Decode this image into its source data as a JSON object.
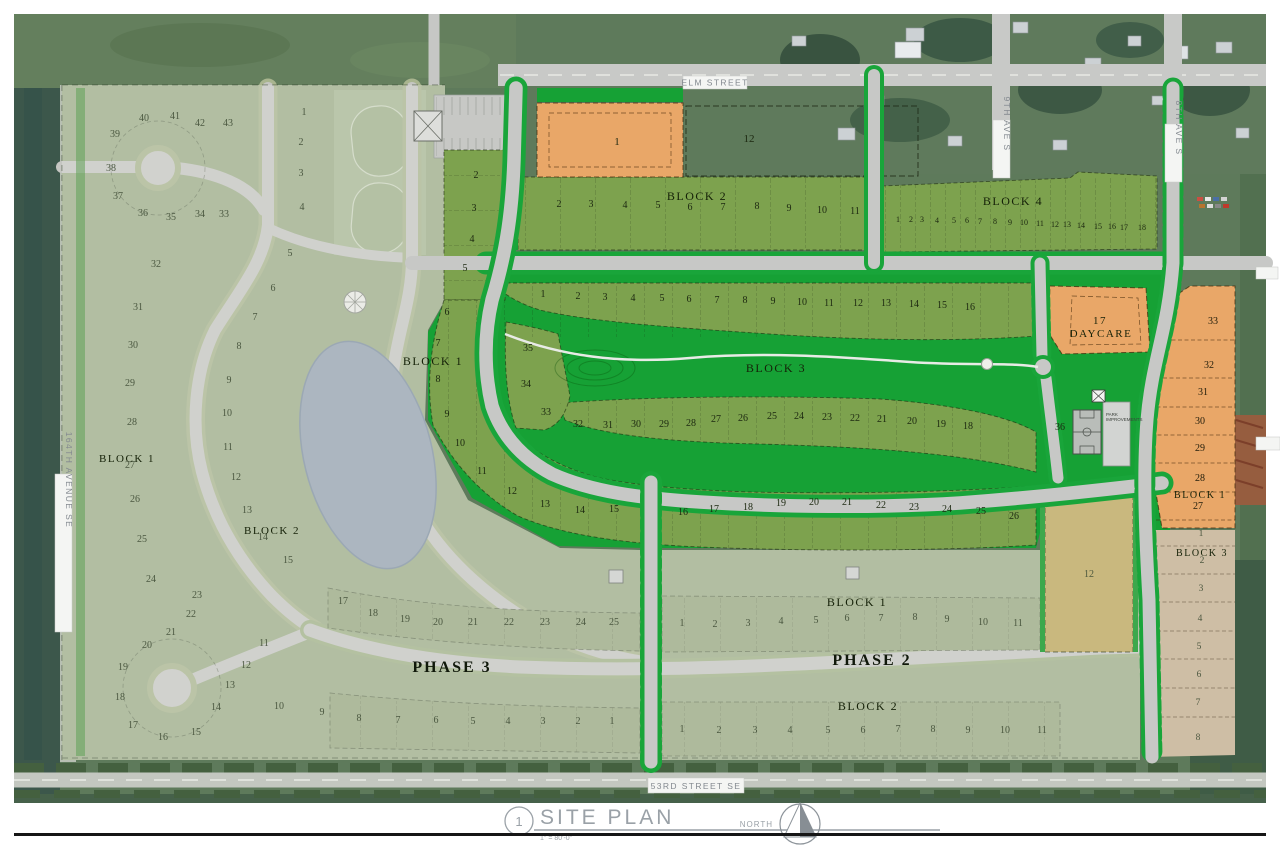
{
  "drawing": {
    "title_block": {
      "detail_number": "1",
      "title": "SITE PLAN",
      "scale": "1\" = 80'-0\"",
      "north_label": "NORTH"
    },
    "streets": {
      "elm": "ELM STREET",
      "ninth_ave": "9TH AVE S",
      "eighth_ave": "8TH AVE S",
      "avenue_164": "164TH AVENUE SE",
      "street_53": "53RD STREET SE"
    },
    "phases": {
      "phase2": "PHASE 2",
      "phase3": "PHASE 3"
    },
    "special_lots": {
      "daycare_number": "17",
      "daycare_label": "DAYCARE",
      "park_improvements_line1": "PARK",
      "park_improvements_line2": "IMPROVEMENTS"
    },
    "block_labels": [
      [
        "BLOCK 2",
        697,
        200,
        12
      ],
      [
        "BLOCK 4",
        1013,
        205,
        12
      ],
      [
        "BLOCK 3",
        776,
        372,
        12
      ],
      [
        "BLOCK 1",
        433,
        365,
        12
      ],
      [
        "BLOCK 1",
        1200,
        498,
        10
      ],
      [
        "BLOCK 3",
        1202,
        556,
        10
      ],
      [
        "BLOCK 1",
        127,
        462,
        11
      ],
      [
        "BLOCK 2",
        272,
        534,
        11
      ],
      [
        "BLOCK 1",
        857,
        606,
        12
      ],
      [
        "BLOCK 2",
        868,
        710,
        12
      ]
    ],
    "lot_groups": [
      {
        "name": "block2-north",
        "cls": "active",
        "fs": 10,
        "lots": [
          [
            "2",
            559,
            207
          ],
          [
            "3",
            591,
            207
          ],
          [
            "4",
            625,
            208
          ],
          [
            "5",
            658,
            208
          ],
          [
            "6",
            690,
            210
          ],
          [
            "7",
            723,
            210
          ],
          [
            "8",
            757,
            209
          ],
          [
            "9",
            789,
            211
          ],
          [
            "10",
            822,
            213
          ],
          [
            "11",
            855,
            214
          ]
        ]
      },
      {
        "name": "block4",
        "cls": "active",
        "fs": 8,
        "lots": [
          [
            "1",
            898,
            222
          ],
          [
            "2",
            911,
            222
          ],
          [
            "3",
            922,
            222
          ],
          [
            "4",
            937,
            223
          ],
          [
            "5",
            954,
            223
          ],
          [
            "6",
            967,
            223
          ],
          [
            "7",
            980,
            224
          ],
          [
            "8",
            995,
            224
          ],
          [
            "9",
            1010,
            225
          ],
          [
            "10",
            1024,
            225
          ],
          [
            "11",
            1040,
            226
          ],
          [
            "12",
            1055,
            227
          ],
          [
            "13",
            1067,
            227
          ],
          [
            "14",
            1081,
            228
          ],
          [
            "15",
            1098,
            229
          ],
          [
            "16",
            1112,
            229
          ],
          [
            "17",
            1124,
            230
          ],
          [
            "18",
            1142,
            230
          ]
        ]
      },
      {
        "name": "block3-top-row",
        "cls": "active",
        "fs": 10,
        "lots": [
          [
            "1",
            543,
            297
          ],
          [
            "2",
            578,
            299
          ],
          [
            "3",
            605,
            300
          ],
          [
            "4",
            633,
            301
          ],
          [
            "5",
            662,
            301
          ],
          [
            "6",
            689,
            302
          ],
          [
            "7",
            717,
            303
          ],
          [
            "8",
            745,
            303
          ],
          [
            "9",
            773,
            304
          ],
          [
            "10",
            802,
            305
          ],
          [
            "11",
            829,
            306
          ],
          [
            "12",
            858,
            306
          ],
          [
            "13",
            886,
            306
          ],
          [
            "14",
            914,
            307
          ],
          [
            "15",
            942,
            308
          ],
          [
            "16",
            970,
            310
          ]
        ]
      },
      {
        "name": "block3-inner-row",
        "cls": "active",
        "fs": 10,
        "lots": [
          [
            "35",
            528,
            351
          ],
          [
            "34",
            526,
            387
          ],
          [
            "33",
            546,
            415
          ],
          [
            "32",
            578,
            427
          ],
          [
            "31",
            608,
            428
          ],
          [
            "30",
            636,
            427
          ],
          [
            "29",
            664,
            427
          ],
          [
            "28",
            691,
            426
          ],
          [
            "27",
            716,
            422
          ],
          [
            "26",
            743,
            421
          ],
          [
            "25",
            772,
            419
          ],
          [
            "24",
            799,
            419
          ],
          [
            "23",
            827,
            420
          ],
          [
            "22",
            855,
            421
          ],
          [
            "21",
            882,
            422
          ],
          [
            "20",
            912,
            424
          ],
          [
            "19",
            941,
            427
          ],
          [
            "18",
            968,
            429
          ]
        ]
      },
      {
        "name": "block1-east-outer",
        "cls": "active",
        "fs": 10,
        "lots": [
          [
            "2",
            476,
            178
          ],
          [
            "3",
            474,
            211
          ],
          [
            "4",
            472,
            242
          ],
          [
            "5",
            465,
            271
          ],
          [
            "6",
            447,
            315
          ],
          [
            "7",
            438,
            346
          ],
          [
            "8",
            438,
            382
          ],
          [
            "9",
            447,
            417
          ],
          [
            "10",
            460,
            446
          ],
          [
            "11",
            482,
            474
          ],
          [
            "12",
            512,
            494
          ],
          [
            "13",
            545,
            507
          ],
          [
            "14",
            580,
            513
          ],
          [
            "15",
            614,
            512
          ],
          [
            "16",
            683,
            515
          ],
          [
            "17",
            714,
            512
          ],
          [
            "18",
            748,
            510
          ],
          [
            "19",
            781,
            506
          ],
          [
            "20",
            814,
            505
          ],
          [
            "21",
            847,
            505
          ],
          [
            "22",
            881,
            508
          ],
          [
            "23",
            914,
            510
          ],
          [
            "24",
            947,
            512
          ],
          [
            "25",
            981,
            514
          ],
          [
            "26",
            1014,
            519
          ]
        ]
      },
      {
        "name": "right-orange-column",
        "cls": "orange-lots",
        "fs": 10,
        "lots": [
          [
            "33",
            1213,
            324
          ],
          [
            "32",
            1209,
            368
          ],
          [
            "31",
            1203,
            395
          ],
          [
            "30",
            1200,
            424
          ],
          [
            "29",
            1200,
            451
          ],
          [
            "28",
            1200,
            481
          ],
          [
            "27",
            1198,
            509
          ]
        ]
      },
      {
        "name": "right-tan-column",
        "cls": "faded",
        "fs": 9.5,
        "lots": [
          [
            "1",
            1201,
            536
          ],
          [
            "2",
            1202,
            563
          ],
          [
            "3",
            1201,
            591
          ],
          [
            "4",
            1200,
            621
          ],
          [
            "5",
            1199,
            649
          ],
          [
            "6",
            1199,
            677
          ],
          [
            "7",
            1198,
            705
          ],
          [
            "8",
            1198,
            740
          ]
        ]
      },
      {
        "name": "phase3-north-row",
        "cls": "faded",
        "fs": 10,
        "lots": [
          [
            "17",
            343,
            604
          ],
          [
            "18",
            373,
            616
          ],
          [
            "19",
            405,
            622
          ],
          [
            "20",
            438,
            625
          ],
          [
            "21",
            473,
            625
          ],
          [
            "22",
            509,
            625
          ],
          [
            "23",
            545,
            625
          ],
          [
            "24",
            581,
            625
          ],
          [
            "25",
            614,
            625
          ]
        ]
      },
      {
        "name": "phase3-south-row",
        "cls": "faded",
        "fs": 10,
        "lots": [
          [
            "10",
            279,
            709
          ],
          [
            "9",
            322,
            715
          ],
          [
            "8",
            359,
            721
          ],
          [
            "7",
            398,
            723
          ],
          [
            "6",
            436,
            723
          ],
          [
            "5",
            473,
            724
          ],
          [
            "4",
            508,
            724
          ],
          [
            "3",
            543,
            724
          ],
          [
            "2",
            578,
            724
          ],
          [
            "1",
            612,
            724
          ]
        ]
      },
      {
        "name": "phase2-north-row",
        "cls": "faded",
        "fs": 10,
        "lots": [
          [
            "1",
            682,
            626
          ],
          [
            "2",
            715,
            627
          ],
          [
            "3",
            748,
            626
          ],
          [
            "4",
            781,
            624
          ],
          [
            "5",
            816,
            623
          ],
          [
            "6",
            847,
            621
          ],
          [
            "7",
            881,
            621
          ],
          [
            "8",
            915,
            620
          ],
          [
            "9",
            947,
            622
          ],
          [
            "10",
            983,
            625
          ],
          [
            "11",
            1018,
            626
          ]
        ]
      },
      {
        "name": "phase2-south-row",
        "cls": "faded",
        "fs": 10,
        "lots": [
          [
            "1",
            682,
            732
          ],
          [
            "2",
            719,
            733
          ],
          [
            "3",
            755,
            733
          ],
          [
            "4",
            790,
            733
          ],
          [
            "5",
            828,
            733
          ],
          [
            "6",
            863,
            733
          ],
          [
            "7",
            898,
            732
          ],
          [
            "8",
            933,
            732
          ],
          [
            "9",
            968,
            733
          ],
          [
            "10",
            1005,
            733
          ],
          [
            "11",
            1042,
            733
          ]
        ]
      },
      {
        "name": "northwest-outer",
        "cls": "faded",
        "fs": 10,
        "lots": [
          [
            "40",
            144,
            121
          ],
          [
            "41",
            175,
            119
          ],
          [
            "42",
            200,
            126
          ],
          [
            "43",
            228,
            126
          ],
          [
            "39",
            115,
            137
          ],
          [
            "38",
            111,
            171
          ],
          [
            "37",
            118,
            199
          ],
          [
            "36",
            143,
            216
          ],
          [
            "35",
            171,
            220
          ],
          [
            "34",
            200,
            217
          ],
          [
            "33",
            224,
            217
          ],
          [
            "32",
            156,
            267
          ],
          [
            "31",
            138,
            310
          ],
          [
            "30",
            133,
            348
          ],
          [
            "29",
            130,
            386
          ],
          [
            "28",
            132,
            425
          ],
          [
            "27",
            130,
            468
          ],
          [
            "26",
            135,
            502
          ],
          [
            "25",
            142,
            542
          ],
          [
            "24",
            151,
            582
          ],
          [
            "23",
            197,
            598
          ]
        ]
      },
      {
        "name": "northwest-column",
        "cls": "faded",
        "fs": 10,
        "lots": [
          [
            "1",
            304,
            115
          ],
          [
            "2",
            301,
            145
          ],
          [
            "3",
            301,
            176
          ],
          [
            "4",
            302,
            210
          ],
          [
            "5",
            290,
            256
          ],
          [
            "6",
            273,
            291
          ],
          [
            "7",
            255,
            320
          ]
        ]
      },
      {
        "name": "west-inner-ring",
        "cls": "faded",
        "fs": 10,
        "lots": [
          [
            "8",
            239,
            349
          ],
          [
            "9",
            229,
            383
          ],
          [
            "10",
            227,
            416
          ],
          [
            "11",
            228,
            450
          ],
          [
            "12",
            236,
            480
          ],
          [
            "13",
            247,
            513
          ],
          [
            "14",
            263,
            540
          ],
          [
            "15",
            288,
            563
          ]
        ]
      },
      {
        "name": "southwest-culdesac",
        "cls": "faded",
        "fs": 10,
        "lots": [
          [
            "11",
            264,
            646
          ],
          [
            "12",
            246,
            668
          ],
          [
            "13",
            230,
            688
          ],
          [
            "14",
            216,
            710
          ],
          [
            "15",
            196,
            735
          ],
          [
            "16",
            163,
            740
          ],
          [
            "17",
            133,
            728
          ],
          [
            "18",
            120,
            700
          ],
          [
            "19",
            123,
            670
          ],
          [
            "20",
            147,
            648
          ],
          [
            "21",
            171,
            635
          ],
          [
            "22",
            191,
            617
          ]
        ]
      },
      {
        "name": "lot-commercial",
        "cls": "active",
        "fs": 11,
        "lots": [
          [
            "1",
            617,
            145
          ]
        ]
      },
      {
        "name": "lot-open-parcel",
        "cls": "active",
        "fs": 11,
        "lots": [
          [
            "12",
            749,
            142
          ]
        ]
      },
      {
        "name": "lot-park",
        "cls": "active",
        "fs": 10,
        "lots": [
          [
            "36",
            1060,
            430
          ]
        ]
      },
      {
        "name": "lot-school-site",
        "cls": "faded",
        "fs": 10,
        "lots": [
          [
            "12",
            1089,
            577
          ]
        ]
      }
    ]
  },
  "colors": {
    "active_lot_green": "#7da24e",
    "park_green": "#16a135",
    "faded_green": "#9cac89",
    "orange_lot": "#e9a768",
    "road_gray": "#c7c8c6",
    "pond_blue": "#94a2b1",
    "tan_lot": "#c9b87e"
  }
}
